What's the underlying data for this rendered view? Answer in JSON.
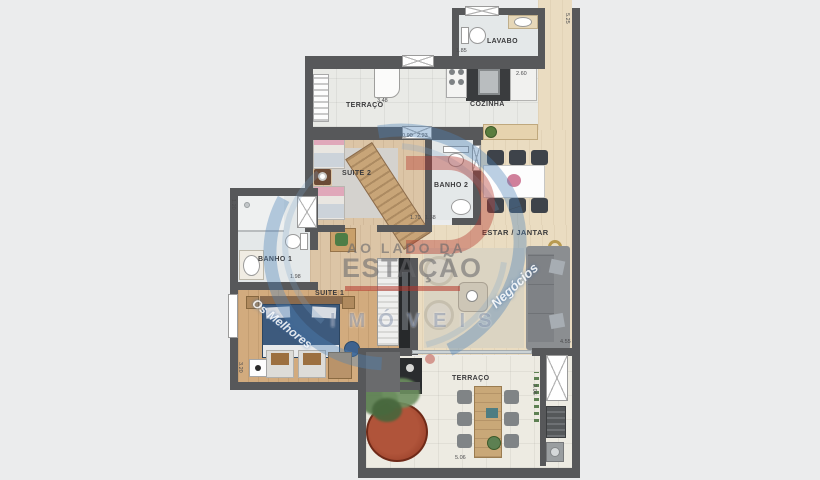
{
  "canvas": {
    "width": 820,
    "height": 480,
    "background": "#ebeced",
    "wall_color": "#57585a"
  },
  "rooms": {
    "lavabo": {
      "label": "LAVABO"
    },
    "terraco_top": {
      "label": "TERRAÇO"
    },
    "cozinha": {
      "label": "COZINHA"
    },
    "suite2": {
      "label": "SUITE 2"
    },
    "banho2": {
      "label": "BANHO 2"
    },
    "estar_jantar": {
      "label": "ESTAR / JANTAR"
    },
    "banho1": {
      "label": "BANHO 1"
    },
    "suite1": {
      "label": "SUITE 1"
    },
    "terraco_bottom": {
      "label": "TERRAÇO"
    }
  },
  "dimensions": [
    {
      "v": "1.85",
      "x": 456,
      "y": 48,
      "r": 0
    },
    {
      "v": "5.25",
      "x": 570,
      "y": 13,
      "r": 90
    },
    {
      "v": "3.48",
      "x": 377,
      "y": 98,
      "r": 0
    },
    {
      "v": "2.60",
      "x": 516,
      "y": 71,
      "r": 0
    },
    {
      "v": "0.90",
      "x": 402,
      "y": 133,
      "r": 0
    },
    {
      "v": "2.23",
      "x": 417,
      "y": 133,
      "r": 0
    },
    {
      "v": "1.70",
      "x": 410,
      "y": 215,
      "r": 0
    },
    {
      "v": "1.38",
      "x": 425,
      "y": 215,
      "r": 0
    },
    {
      "v": "1.20",
      "x": 236,
      "y": 199,
      "r": 90
    },
    {
      "v": "1.98",
      "x": 290,
      "y": 274,
      "r": 0
    },
    {
      "v": "3.20",
      "x": 243,
      "y": 362,
      "r": 90
    },
    {
      "v": "4.55",
      "x": 560,
      "y": 339,
      "r": 0
    },
    {
      "v": "2.06",
      "x": 537,
      "y": 384,
      "r": 90
    },
    {
      "v": "5.06",
      "x": 455,
      "y": 455,
      "r": 0
    }
  ],
  "watermark": {
    "line1": "AO LADO DA",
    "line2": "ESTAÇÃO",
    "brand": "IMÓVEIS",
    "arc_left": "Os Melhores",
    "arc_right": "Negócios",
    "blue": "#4f83b8",
    "red": "#b5342a"
  }
}
